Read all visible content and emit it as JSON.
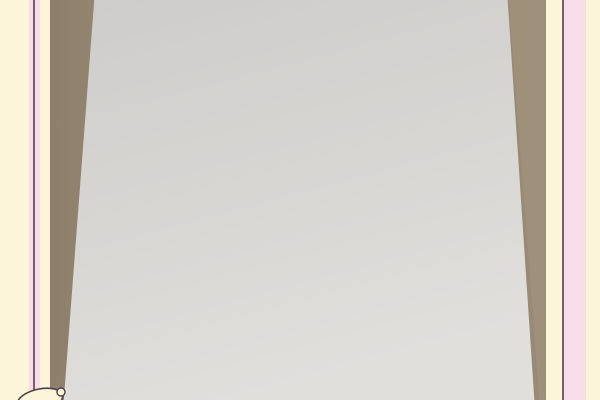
{
  "meta": {
    "description": "Photograph of a Chinese feng-shui luopan compass chart sheet laid over an architectural floor-plan drawing on a wooden desk, inside a pale pink-and-cream photo frame border"
  },
  "frame": {
    "cream": "#fcf5d9",
    "pink": "#f6dde8",
    "line": "#7b5a6b"
  },
  "photo": {
    "wood_base": "#a5967f",
    "wood_dark": "#8b7d69",
    "wood_light": "#b9aa93",
    "paper": "#d8d6d3",
    "paper_shade": "#c9c7c4",
    "sheet": "#ece5dc",
    "sheet_edge": "#c3bbae"
  },
  "plan": {
    "ink": "#77716c",
    "red_text": "坤水吉山 金槌玉英 永鎮天"
  },
  "compass": {
    "center_x": 274,
    "center_y": 227,
    "x_scale": 0.95,
    "outer_radius": 170,
    "ink": "#332e29",
    "red": "#bb4f2f",
    "red_dark": "#8d2f16",
    "bright_red": "#c13526",
    "green": "#4c7c3a",
    "center_fill": "#f0e9dd",
    "sight_line_color": "#c25244",
    "sight_line_count": 12,
    "rings": [
      {
        "name": "tick-ring",
        "type": "ticks",
        "r0": 159,
        "r1": 169,
        "n": 120
      },
      {
        "name": "fine-text-ring",
        "type": "dense",
        "r0": 149,
        "r1": 159
      },
      {
        "name": "block-ring-1",
        "type": "sectors",
        "r0": 133,
        "r1": 149,
        "n": 24,
        "red_every": 3
      },
      {
        "name": "dense-ring-2",
        "type": "dense",
        "r0": 124,
        "r1": 133
      },
      {
        "name": "block-ring-2",
        "type": "sectors",
        "r0": 108,
        "r1": 124,
        "n": 16,
        "red_every": 4
      },
      {
        "name": "dense-ring-3",
        "type": "dense",
        "r0": 97,
        "r1": 108
      },
      {
        "name": "red-loop-ring",
        "type": "loops",
        "r0": 83,
        "r1": 97,
        "n": 12
      },
      {
        "name": "dense-ring-4",
        "type": "dense",
        "r0": 71,
        "r1": 83
      },
      {
        "name": "block-ring-3",
        "type": "sectors",
        "r0": 57,
        "r1": 71,
        "n": 8,
        "red_every": 2
      },
      {
        "name": "dense-ring-5",
        "type": "dense",
        "r0": 46,
        "r1": 57
      }
    ],
    "center": {
      "radius": 44,
      "sectors": [
        {
          "char": "離",
          "angle": -90,
          "color": "bright_red"
        },
        {
          "char": "坤",
          "angle": -45,
          "color": "ink"
        },
        {
          "char": "兌",
          "angle": 0,
          "color": "ink"
        },
        {
          "char": "乾",
          "angle": 45,
          "color": "red"
        },
        {
          "char": "坎",
          "angle": 90,
          "color": "ink"
        },
        {
          "char": "艮",
          "angle": 135,
          "color": "green"
        },
        {
          "char": "震",
          "angle": 180,
          "color": "green"
        },
        {
          "char": "巽",
          "angle": -135,
          "color": "red"
        }
      ]
    }
  }
}
